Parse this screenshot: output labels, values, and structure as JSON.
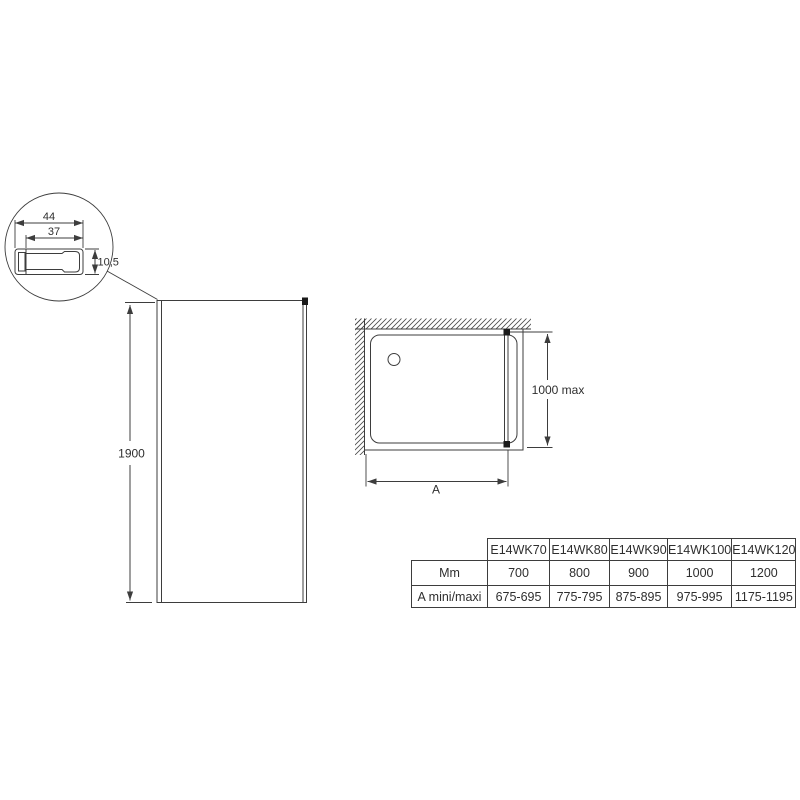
{
  "detail_view": {
    "outer_width": "44",
    "inner_width": "37",
    "profile_height": "10,5"
  },
  "front_view": {
    "height": "1900"
  },
  "plan_view": {
    "depth_max": "1000 max",
    "width_dim": "A"
  },
  "table": {
    "models": [
      "E14WK70",
      "E14WK80",
      "E14WK90",
      "E14WK100",
      "E14WK120"
    ],
    "rows": [
      {
        "label": "Mm",
        "values": [
          "700",
          "800",
          "900",
          "1000",
          "1200"
        ]
      },
      {
        "label": "A mini/maxi",
        "values": [
          "675-695",
          "775-795",
          "875-895",
          "975-995",
          "1175-1195"
        ]
      }
    ]
  },
  "colors": {
    "line": "#3d3d3d",
    "text": "#2e2e2e",
    "bracket": "#1a1a1a",
    "background": "#ffffff"
  }
}
